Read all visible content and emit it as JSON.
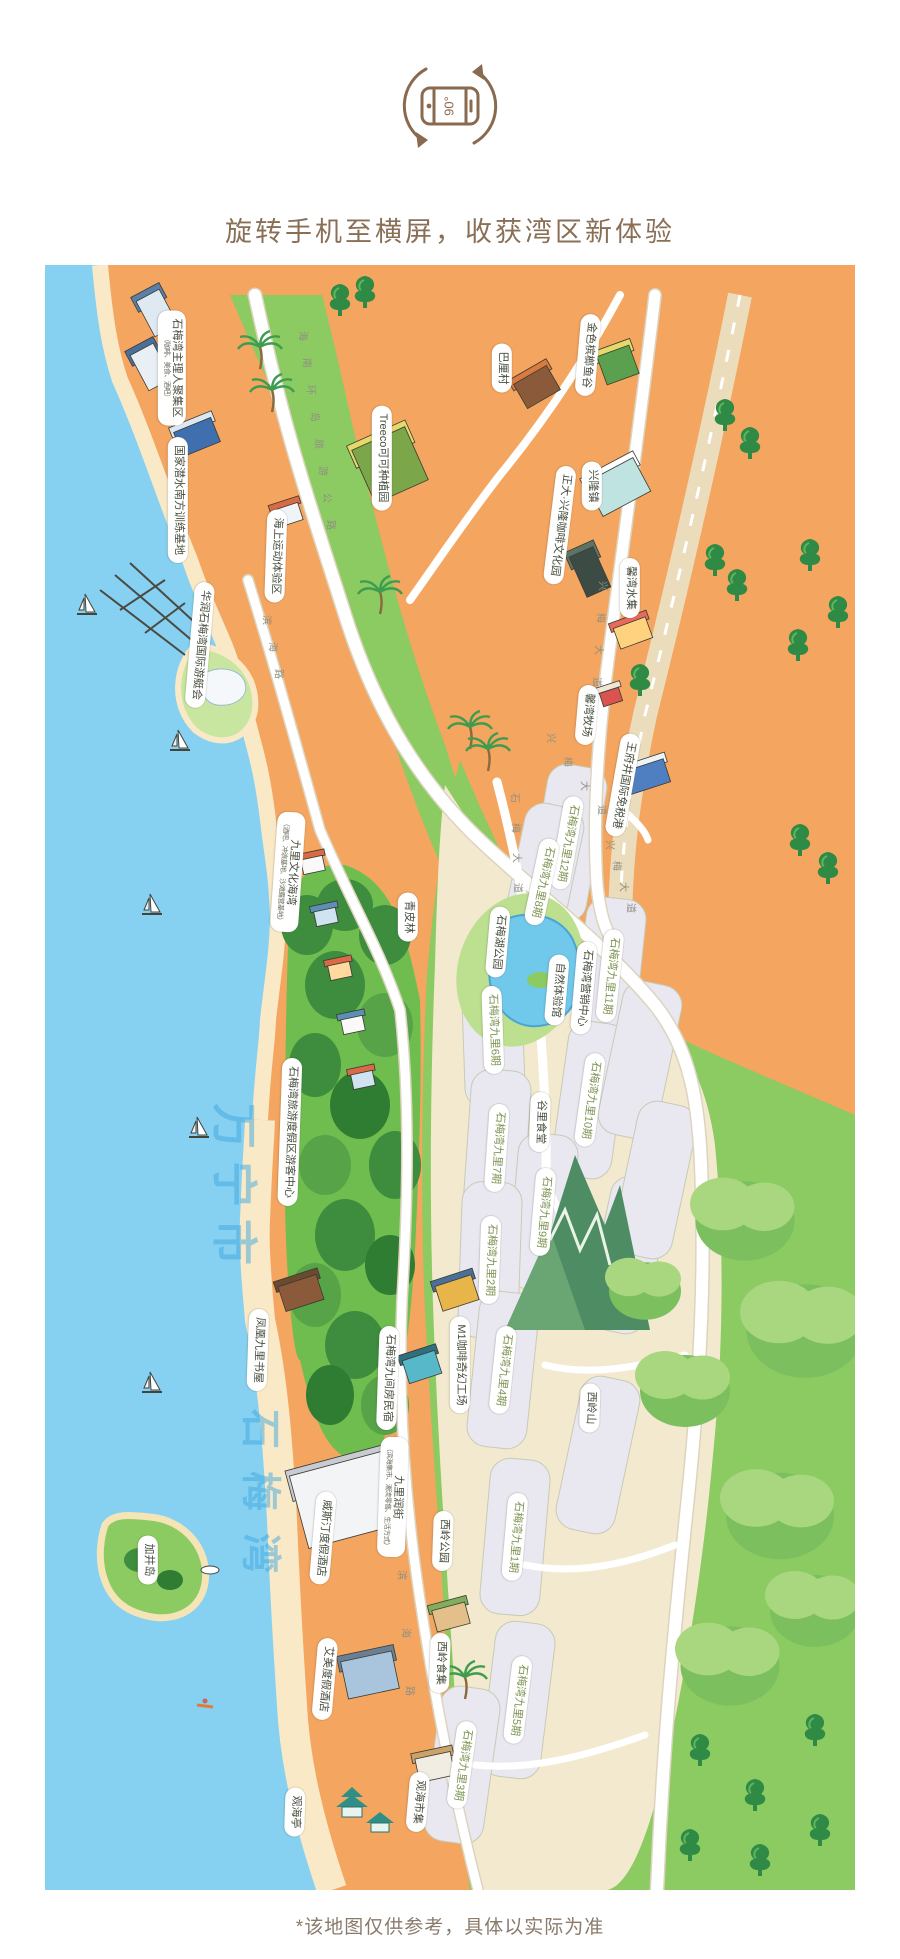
{
  "header": {
    "icon": "rotate-phone-90-icon",
    "rotate_text": "90°",
    "title": "旋转手机至横屏，收获湾区新体验"
  },
  "footer": {
    "disclaimer": "*该地图仅供参考，具体以实际为准"
  },
  "map": {
    "region_names": {
      "city": "万宁市",
      "bay": "石梅湾"
    },
    "sea_labels": [
      {
        "text": "万宁市",
        "x": 237,
        "y": 1190,
        "size": 46,
        "ls": 12
      },
      {
        "text": "石梅湾",
        "x": 264,
        "y": 1502,
        "size": 40,
        "ls": 22
      }
    ],
    "road_labels": [
      {
        "text": "海南环岛旅游公路",
        "x": 304,
        "y": 336,
        "dx": 4,
        "dy": 27
      },
      {
        "text": "兴梅大道",
        "x": 604,
        "y": 586,
        "dx": -2,
        "dy": 32
      },
      {
        "text": "兴梅大道",
        "x": 552,
        "y": 738,
        "dx": 17,
        "dy": 24
      },
      {
        "text": "兴梅大道",
        "x": 611,
        "y": 845,
        "dx": 7,
        "dy": 21
      },
      {
        "text": "石梅大道",
        "x": 516,
        "y": 798,
        "dx": 1,
        "dy": 30
      },
      {
        "text": "滨海路",
        "x": 268,
        "y": 620,
        "dx": 6,
        "dy": 27
      },
      {
        "text": "滨海路",
        "x": 403,
        "y": 1575,
        "dx": 4,
        "dy": 58
      }
    ],
    "places": [
      {
        "label": "石梅湾主理人聚集区",
        "sub": "（咖啡、美食、酒吧）",
        "x": 172,
        "y": 368,
        "kind": "amenity",
        "rot": 90
      },
      {
        "label": "国家潜水南方训练基地",
        "x": 178,
        "y": 500,
        "kind": "amenity",
        "rot": 90
      },
      {
        "label": "海上运动体验区",
        "x": 276,
        "y": 556,
        "kind": "amenity",
        "rot": 92
      },
      {
        "label": "华润石梅湾国际游艇会",
        "x": 200,
        "y": 645,
        "kind": "amenity",
        "rot": 95
      },
      {
        "label": "Treeco可可种植园",
        "x": 382,
        "y": 458,
        "kind": "amenity",
        "rot": 90
      },
      {
        "label": "巴厘村",
        "x": 502,
        "y": 368,
        "kind": "amenity",
        "rot": 90
      },
      {
        "label": "金色槟榔鱼谷",
        "x": 588,
        "y": 355,
        "kind": "amenity",
        "rot": 95
      },
      {
        "label": "兴隆镇",
        "x": 592,
        "y": 486,
        "kind": "amenity",
        "rot": 90
      },
      {
        "label": "正大·兴隆咖啡文化园",
        "x": 560,
        "y": 525,
        "kind": "amenity",
        "rot": 97
      },
      {
        "label": "馨湾水集",
        "x": 630,
        "y": 588,
        "kind": "amenity",
        "rot": 90
      },
      {
        "label": "馨湾牧场",
        "x": 587,
        "y": 715,
        "kind": "amenity",
        "rot": 95
      },
      {
        "label": "王府井国际免税港",
        "x": 623,
        "y": 785,
        "kind": "amenity",
        "rot": 100
      },
      {
        "label": "九里文化海湾",
        "sub": "（酒吧、冲浪基地、沙滩露营基地）",
        "x": 288,
        "y": 872,
        "kind": "amenity",
        "rot": 94
      },
      {
        "label": "青皮林",
        "x": 408,
        "y": 917,
        "kind": "amenity",
        "rot": 90
      },
      {
        "label": "石梅湖公园",
        "x": 498,
        "y": 942,
        "kind": "amenity",
        "rot": 95
      },
      {
        "label": "自然体验馆",
        "x": 557,
        "y": 990,
        "kind": "amenity",
        "rot": 95
      },
      {
        "label": "石梅湾营销中心",
        "x": 584,
        "y": 988,
        "kind": "amenity",
        "rot": 95
      },
      {
        "label": "谷里食堂",
        "x": 540,
        "y": 1122,
        "kind": "amenity",
        "rot": 92
      },
      {
        "label": "石梅湾旅游度假区游客中心",
        "x": 290,
        "y": 1132,
        "kind": "amenity",
        "rot": 92
      },
      {
        "label": "M1咖啡奇幻工场",
        "x": 460,
        "y": 1365,
        "kind": "amenity",
        "rot": 90
      },
      {
        "label": "石梅湾九间房民宿",
        "x": 388,
        "y": 1378,
        "kind": "amenity",
        "rot": 92
      },
      {
        "label": "凤凰九里书屋",
        "x": 258,
        "y": 1350,
        "kind": "amenity",
        "rot": 92
      },
      {
        "label": "九里润街",
        "sub": "（滨海集市、潮流零售、生活方式）",
        "x": 393,
        "y": 1497,
        "kind": "amenity",
        "rot": 92
      },
      {
        "label": "威斯汀度假酒店",
        "x": 323,
        "y": 1538,
        "kind": "amenity",
        "rot": 95
      },
      {
        "label": "艾美度假酒店",
        "x": 325,
        "y": 1679,
        "kind": "amenity",
        "rot": 95
      },
      {
        "label": "西岭公园",
        "x": 443,
        "y": 1541,
        "kind": "amenity",
        "rot": 92
      },
      {
        "label": "西岭食集",
        "x": 440,
        "y": 1663,
        "kind": "amenity",
        "rot": 92
      },
      {
        "label": "西岭山",
        "x": 590,
        "y": 1408,
        "kind": "amenity",
        "rot": 92
      },
      {
        "label": "加井岛",
        "x": 148,
        "y": 1560,
        "kind": "amenity",
        "rot": 90
      },
      {
        "label": "观海亭",
        "x": 295,
        "y": 1812,
        "kind": "amenity",
        "rot": 92
      },
      {
        "label": "观海市集",
        "x": 418,
        "y": 1802,
        "kind": "amenity",
        "rot": 95
      },
      {
        "label": "石梅湾九里12期",
        "x": 567,
        "y": 843,
        "kind": "phase",
        "rot": 100
      },
      {
        "label": "石梅湾九里8期",
        "x": 542,
        "y": 882,
        "kind": "phase",
        "rot": 102
      },
      {
        "label": "石梅湾九里11期",
        "x": 610,
        "y": 976,
        "kind": "phase",
        "rot": 96
      },
      {
        "label": "石梅湾九里6期",
        "x": 493,
        "y": 1030,
        "kind": "phase",
        "rot": 88
      },
      {
        "label": "石梅湾九里10期",
        "x": 590,
        "y": 1100,
        "kind": "phase",
        "rot": 98
      },
      {
        "label": "石梅湾九里7期",
        "x": 497,
        "y": 1148,
        "kind": "phase",
        "rot": 94
      },
      {
        "label": "石梅湾九里9期",
        "x": 543,
        "y": 1212,
        "kind": "phase",
        "rot": 95
      },
      {
        "label": "石梅湾九里2期",
        "x": 490,
        "y": 1260,
        "kind": "phase",
        "rot": 92
      },
      {
        "label": "石梅湾九里4期",
        "x": 503,
        "y": 1370,
        "kind": "phase",
        "rot": 96
      },
      {
        "label": "石梅湾九里1期",
        "x": 515,
        "y": 1537,
        "kind": "phase",
        "rot": 95
      },
      {
        "label": "石梅湾九里5期",
        "x": 518,
        "y": 1700,
        "kind": "phase",
        "rot": 97
      },
      {
        "label": "石梅湾九里3期",
        "x": 462,
        "y": 1765,
        "kind": "phase",
        "rot": 98
      }
    ]
  },
  "colors": {
    "sea": "#86D1F1",
    "beach": "#F4A55F",
    "sand": "#F9E9C6",
    "green": "#8CCA62",
    "forest": "#3E8C3E",
    "parcel": "#E9E8F0",
    "parcel_field": "#F3E9CF",
    "road": "#FFFFFF",
    "highway": "#EBDCBB",
    "lake": "#70C8EA",
    "pill_text": "#474E3E",
    "phase_text": "#7E9454",
    "heading": "#8A6F57",
    "watermark": "#3FA8DE"
  }
}
